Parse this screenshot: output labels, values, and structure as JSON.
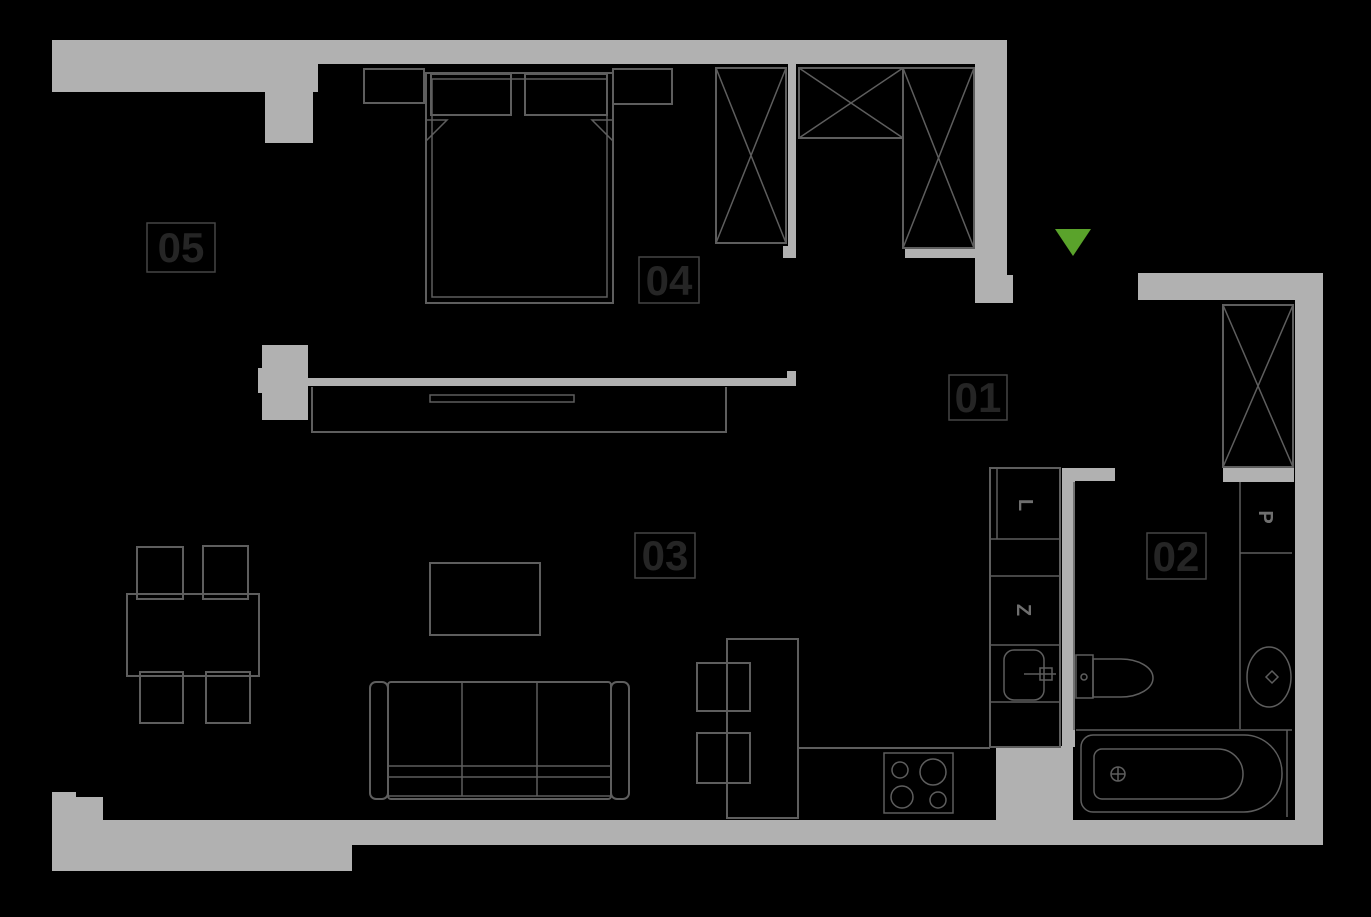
{
  "colors": {
    "background": "#000000",
    "wall-color": "#b1b1b1",
    "line-color": "#5e5e5e",
    "label-border": "#454545",
    "label-text": "#252525",
    "letter-color": "#6f6f6f",
    "entrance-color": "#5aa32b"
  },
  "rooms": [
    {
      "label": "01"
    },
    {
      "label": "02"
    },
    {
      "label": "03"
    },
    {
      "label": "04"
    },
    {
      "label": "05"
    }
  ],
  "appliances": [
    {
      "letter": "L"
    },
    {
      "letter": "Z"
    },
    {
      "letter": "P"
    }
  ],
  "entrance": {
    "symbol": "triangle-down"
  }
}
